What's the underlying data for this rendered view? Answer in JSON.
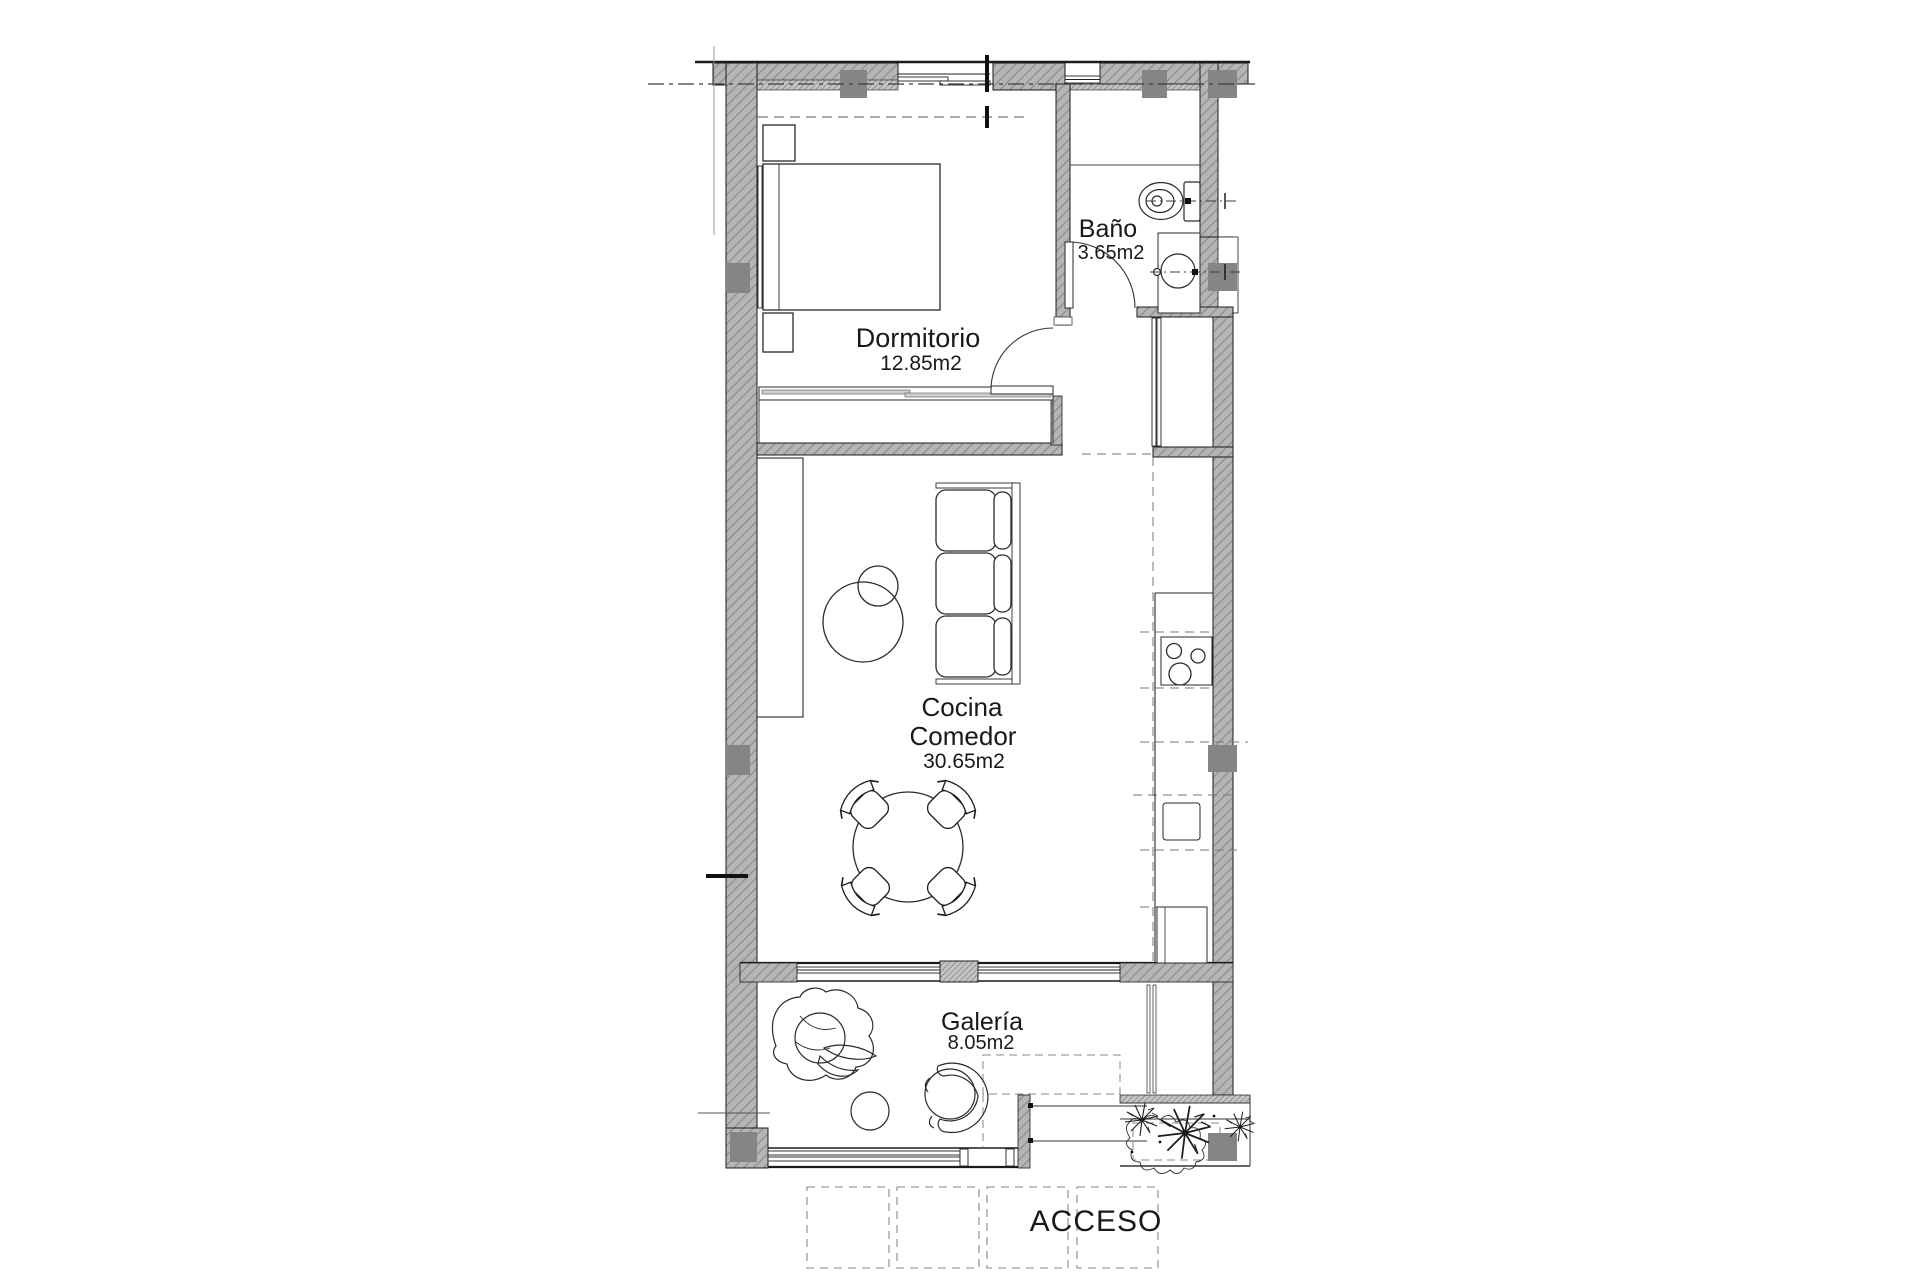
{
  "plan": {
    "labels": {
      "dormitorio": {
        "name": "Dormitorio",
        "area": "12.85m2"
      },
      "bano": {
        "name": "Baño",
        "area": "3.65m2"
      },
      "cocina": {
        "line1": "Cocina",
        "line2": "Comedor",
        "area": "30.65m2"
      },
      "galeria": {
        "name": "Galería",
        "area": "8.05m2"
      },
      "acceso": {
        "name": "ACCESO"
      }
    },
    "colors": {
      "wall_fill": "#b5b5b5",
      "wall_hatch_line": "#8c8c8c",
      "column": "#858585",
      "outline": "#1b1b1b",
      "text": "#191919",
      "dash": "#777777"
    }
  }
}
